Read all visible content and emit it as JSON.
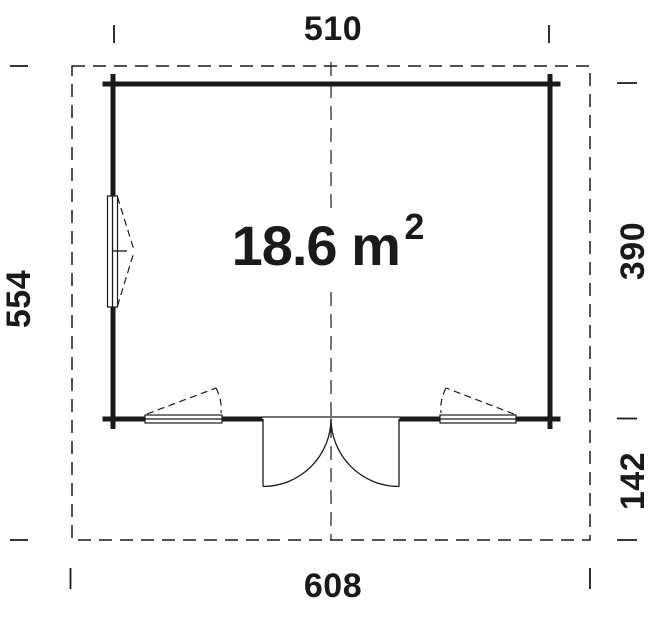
{
  "colors": {
    "line": "#1a1a1a",
    "background": "#ffffff"
  },
  "dimensions": {
    "top_width": "510",
    "bottom_width": "608",
    "left_depth": "554",
    "right_room_depth": "390",
    "right_front_depth": "142"
  },
  "area": {
    "label": "18.6 m",
    "superscript": "2"
  }
}
